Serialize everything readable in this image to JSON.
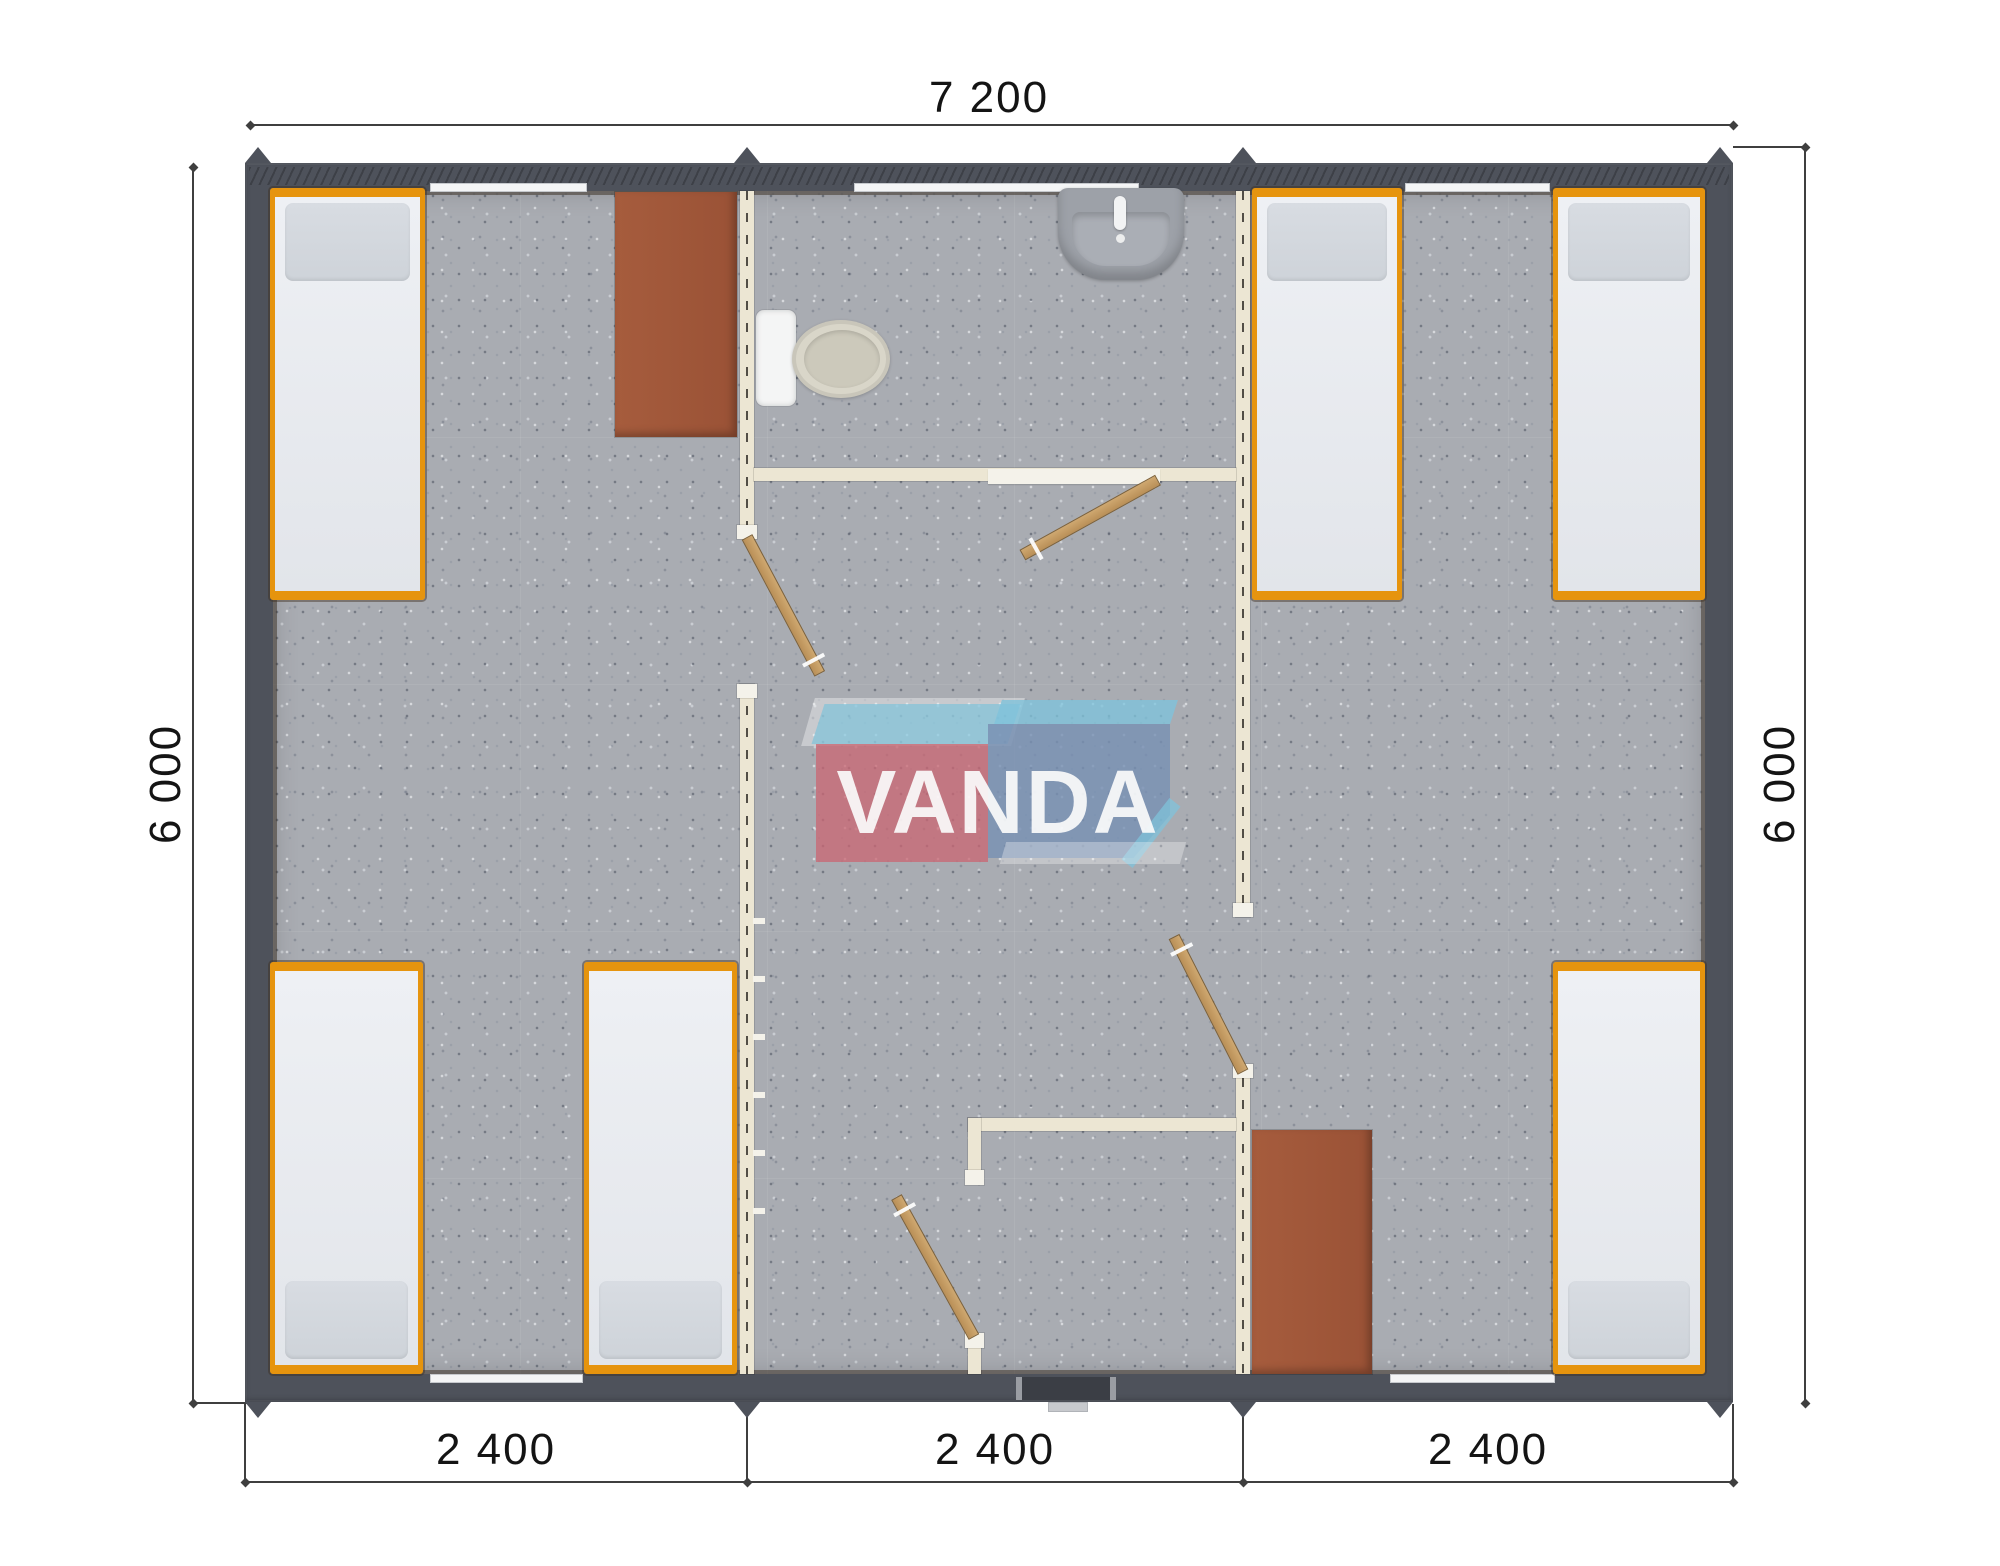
{
  "dimensions": {
    "top": "7 200",
    "left": "6 000",
    "right": "6 000",
    "bottom": [
      "2 400",
      "2 400",
      "2 400"
    ]
  },
  "watermark": {
    "text": "VANDA"
  },
  "plan": {
    "beds": 6,
    "desks": 2,
    "toilets": 1,
    "sinks": 1,
    "interior_doors": 4,
    "entrance_doors": 1,
    "windows": 5
  },
  "colors": {
    "wall": "#4e525b",
    "wall-dark": "#3b3e45",
    "floor": "#a9acb2",
    "partition": "#ece6d3",
    "partition-dash": "#524e46",
    "jamb": "#f4f2ea",
    "accent-orange": "#e6940e",
    "mattress": "#eef0f4",
    "pillow": "#ced3d9",
    "desk": "#9a5236",
    "door-wood": "#cfa870",
    "door-wood-dark": "#b98f57",
    "fixture-gray": "#9da1a8",
    "toilet-beige": "#d9d6c9",
    "window-white": "#f4f5f6",
    "dim-line": "#3f3f3f",
    "dim-text": "#141414",
    "wm-red": "#cb6773",
    "wm-blue": "#7891b4",
    "wm-sky": "#7ec4dd"
  }
}
